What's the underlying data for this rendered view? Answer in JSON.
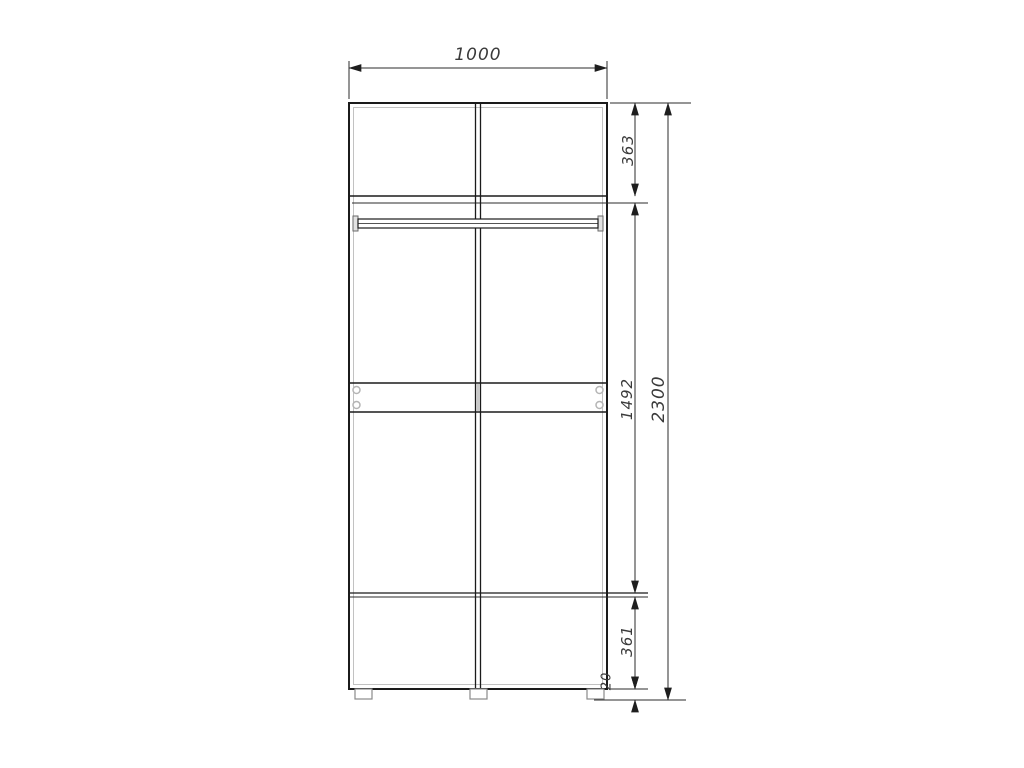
{
  "window": {
    "background": "#ffffff"
  },
  "drawing": {
    "title": "wardrobe-front-elevation",
    "units": "mm",
    "dims": {
      "width": "1000",
      "top_section": "363",
      "middle_section": "1492",
      "bottom_section": "361",
      "plinth_gap": "20",
      "total_height": "2300"
    },
    "colors": {
      "outline": "#1b1b1b",
      "panel_edge": "#c2c2c2",
      "dim_line": "#2b2b2b",
      "dim_text": "#3a3a3a",
      "divider_fill": "#c9c9c9",
      "handle": "#b5b5b5",
      "leg_outline": "#8a8a8a"
    }
  }
}
